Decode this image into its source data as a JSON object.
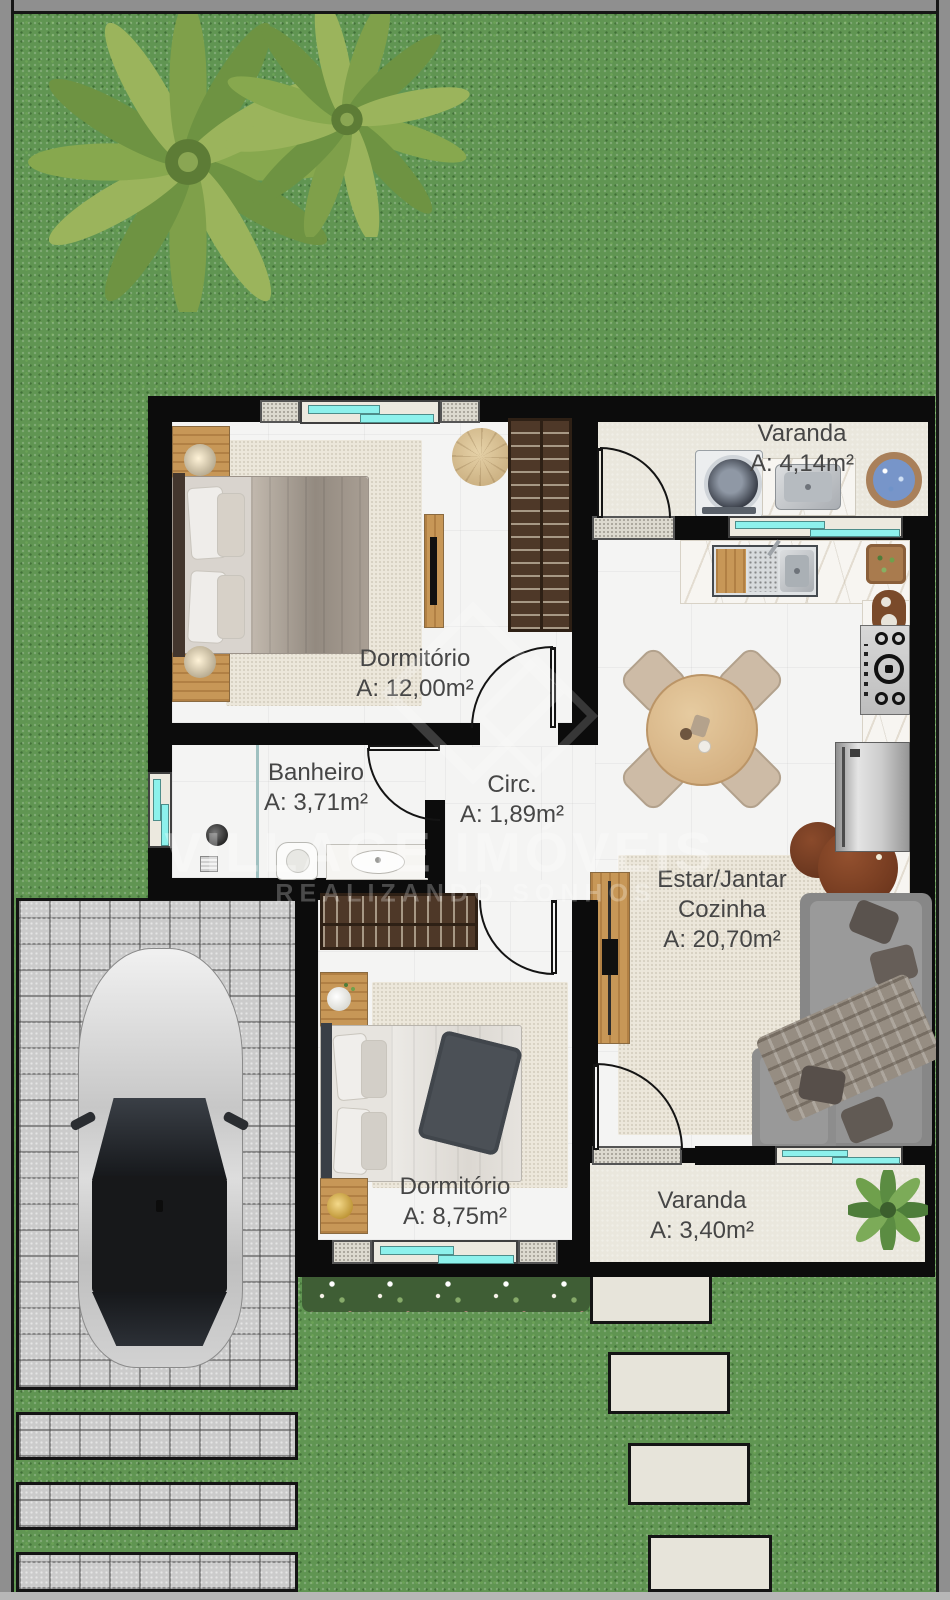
{
  "plan": {
    "watermark": {
      "brand": "VILLAGE IMÓVEIS",
      "tagline": "REALIZANDO SONHOS"
    },
    "rooms": {
      "dormitorio_1": {
        "name": "Dormitório",
        "area": "A: 12,00m²"
      },
      "banheiro": {
        "name": "Banheiro",
        "area": "A: 3,71m²"
      },
      "circulacao": {
        "name": "Circ.",
        "area": "A: 1,89m²"
      },
      "estar_jantar": {
        "name_line_1": "Estar/Jantar",
        "name_line_2": "Cozinha",
        "area": "A: 20,70m²"
      },
      "dormitorio_2": {
        "name": "Dormitório",
        "area": "A: 8,75m²"
      },
      "varanda_servico": {
        "name": "Varanda",
        "area": "A: 4,14m²"
      },
      "varanda_frontal": {
        "name": "Varanda",
        "area": "A: 3,40m²"
      }
    },
    "colors": {
      "grass": "#609552",
      "walls": "#0c0c0c",
      "interior_floor": "#f4f4f3",
      "varanda_floor": "#eae7dd",
      "window_glass": "#8df1ec",
      "pavers": "#cbcbcb",
      "border_frame": "#8f8f8f",
      "rug": "#ece7db",
      "sofa": "#8f8f8f",
      "wood": "#c79757"
    }
  }
}
